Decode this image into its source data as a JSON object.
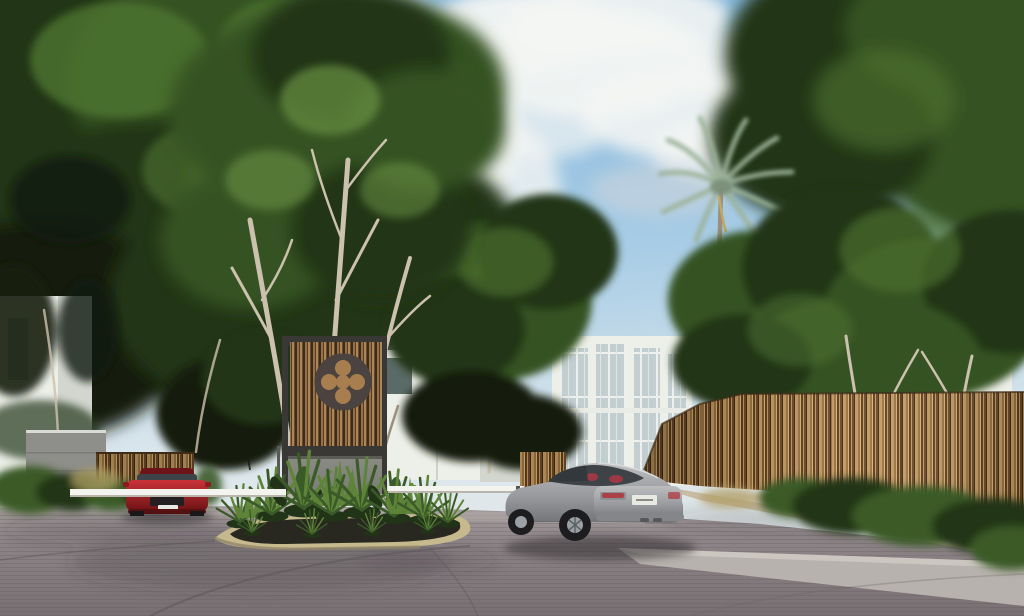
{
  "image": {
    "title": "Gated residential community entrance - exterior architectural rendering",
    "type": "3d-architectural-visualization",
    "visible_text": "none"
  },
  "scene": {
    "sky": "blue sky with white cumulus clouds, bright overexposed cloud behind left tree canopy",
    "vegetation": [
      "dense green tree canopy over left half",
      "tall trees with slender pale trunks rising from median island",
      "single palm tree right of center",
      "mid-size trees above right fence",
      "tropical planting bed on median island (agaves, fan palms, broad leaves)",
      "shrubs at left wall and along right fence"
    ],
    "architecture": [
      "entrance monument: dark metal frame, vertical wood slats, circular quatrefoil emblem, concrete base",
      "white modern villas with glass curtain wall in background",
      "grey stone wall and low wood fence at left gate",
      "long rustic vertical-stick wood fence along right side",
      "white entry gate barrier arms across both lanes"
    ],
    "vehicles": [
      {
        "type": "silver coupe",
        "view": "rear three-quarter",
        "position": "right lane beside fence",
        "plate": "illegible"
      },
      {
        "type": "red sports car",
        "view": "front",
        "position": "waiting behind left barrier arm"
      }
    ],
    "ground": "grey-mauve paver roadway, tan island curb, light concrete apron and sand strip at right"
  },
  "colors": {
    "sky_top": "#7db2d9",
    "sky_mid": "#a9cde6",
    "sky_low": "#dde7ec",
    "cloud_white": "#f3f5f3",
    "canopy_darkest": "#141c0e",
    "canopy_dark": "#233618",
    "canopy_mid": "#365223",
    "canopy_light": "#4e7431",
    "canopy_pale": "#699144",
    "trunk_pale": "#ccc1ad",
    "trunk_mid": "#9a8f7b",
    "palm_frond": "#9db39a",
    "building_white": "#edefe9",
    "building_shade": "#d3d6cf",
    "glass_dark": "#7e918f",
    "glass_pane": "#c3ced0",
    "mullion": "#edf0ec",
    "wall_grey": "#8e8e8a",
    "monument_frame": "#3a3835",
    "medallion": "#4a4340",
    "slat_base": "#8a6540",
    "slat_dark": "#46321e",
    "slat_mid": "#a87e4e",
    "slat_deep": "#5f442a",
    "slat_light": "#c09562",
    "slat_brown": "#74532f",
    "fence_base": "#9c7440",
    "fence_dark": "#6b4a28",
    "fence_darkest": "#3f2c18",
    "fence_light": "#c49a62",
    "fence_pale": "#d8b273",
    "fence_shadow": "#5e3f22",
    "concrete_panel": "#8b8b86",
    "concrete_panel_dark": "#7c7c76",
    "base_light": "#b8b4aa",
    "curb": "#c6b98e",
    "curb_shade": "#91866a",
    "soil": "#282820",
    "plant_dark": "#223418",
    "plant_mid": "#3a5a28",
    "plant_light": "#5e8438",
    "road_far": "#a59c9d",
    "road_mid": "#8d8487",
    "road_near": "#786f73",
    "paver_line": "#5e575a",
    "apron_light": "#b7b2ad",
    "sand": "#c3b291",
    "barrier_white": "#f4f4ef",
    "shadow": "#332e33",
    "car_silver_hi": "#bcbdbf",
    "car_silver_mid": "#999a9e",
    "car_silver_low": "#737478",
    "car_glass": "#3e4347",
    "seat_red": "#a63844",
    "tail_red": "#b03238",
    "plate_white": "#e9e9e4",
    "car_red_hi": "#c93338",
    "car_red": "#a81f24",
    "car_red_dark": "#6e1316"
  }
}
